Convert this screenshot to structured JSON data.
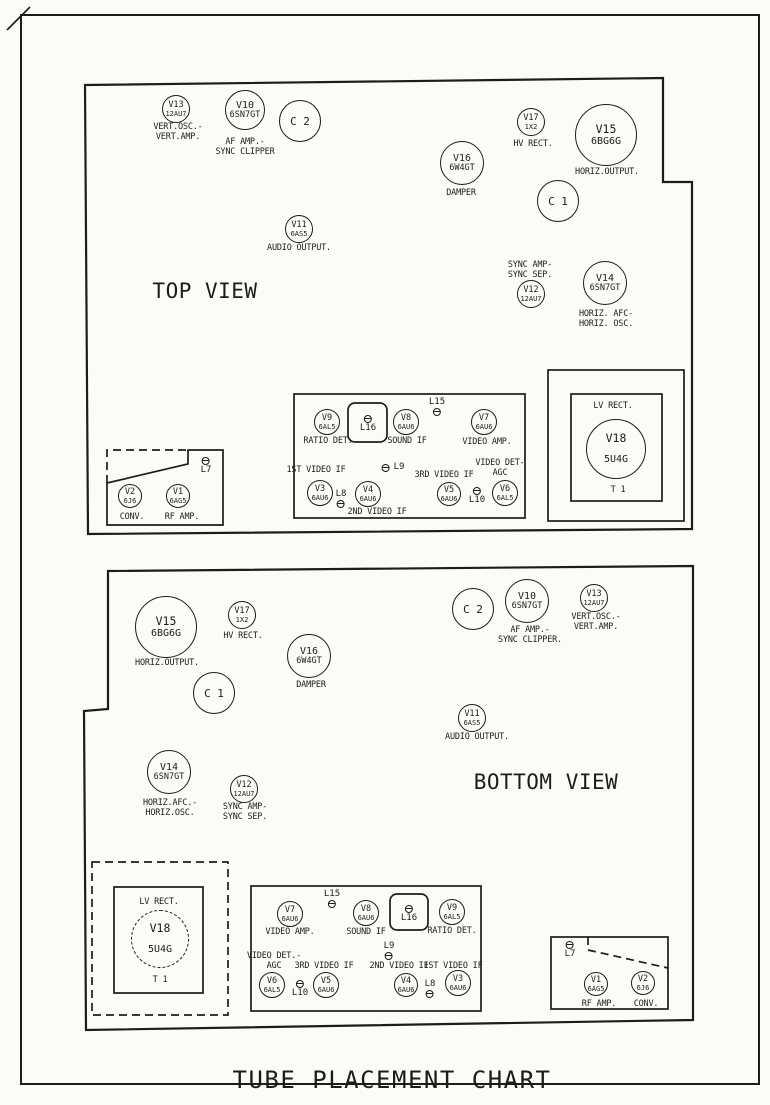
{
  "title": "TUBE PLACEMENT CHART",
  "colors": {
    "ink": "#1c1c1c",
    "paper": "#fbfbf8"
  },
  "marks": [
    {
      "name": "corner-fold-mark",
      "d": "M7,30 L30,7"
    }
  ],
  "panels": [
    {
      "id": "top-view",
      "view_label": {
        "text": "TOP VIEW",
        "x": 205,
        "y": 279
      },
      "outline": [
        [
          85,
          85
        ],
        [
          663,
          78
        ],
        [
          663,
          182
        ],
        [
          692,
          182
        ],
        [
          692,
          529
        ],
        [
          88,
          534
        ]
      ],
      "boxes": [
        {
          "name": "if-strip-box",
          "x": 294,
          "y": 394,
          "w": 231,
          "h": 124
        },
        {
          "name": "coil-l16-box",
          "x": 348,
          "y": 403,
          "w": 39,
          "h": 39,
          "rx": 7
        },
        {
          "name": "lv-rect-outer-box",
          "x": 548,
          "y": 370,
          "w": 136,
          "h": 151
        },
        {
          "name": "lv-rect-inner-box",
          "x": 571,
          "y": 394,
          "w": 91,
          "h": 107
        }
      ],
      "paths": [
        {
          "name": "tuner-box",
          "d": "M107,483 L107,525 L223,525 L223,450 L188,450 L188,464 L107,483"
        },
        {
          "name": "tuner-box-dashed-edge",
          "d": "M107,483 L107,450 L188,450",
          "dash": true
        }
      ],
      "tubes": [
        {
          "id": "V13",
          "type": "12AU7",
          "x": 176,
          "y": 109,
          "r": 14
        },
        {
          "id": "V10",
          "type": "6SN7GT",
          "x": 245,
          "y": 110,
          "r": 20
        },
        {
          "id": "C 2",
          "type": "",
          "x": 300,
          "y": 121,
          "r": 21
        },
        {
          "id": "V17",
          "type": "1X2",
          "x": 531,
          "y": 122,
          "r": 14
        },
        {
          "id": "V15",
          "type": "6BG6G",
          "x": 606,
          "y": 135,
          "r": 31
        },
        {
          "id": "V16",
          "type": "6W4GT",
          "x": 462,
          "y": 163,
          "r": 22
        },
        {
          "id": "C 1",
          "type": "",
          "x": 558,
          "y": 201,
          "r": 21
        },
        {
          "id": "V11",
          "type": "6AS5",
          "x": 299,
          "y": 229,
          "r": 14
        },
        {
          "id": "V12",
          "type": "12AU7",
          "x": 531,
          "y": 294,
          "r": 14
        },
        {
          "id": "V14",
          "type": "6SN7GT",
          "x": 605,
          "y": 283,
          "r": 22
        },
        {
          "id": "V9",
          "type": "6AL5",
          "x": 327,
          "y": 422,
          "r": 13
        },
        {
          "id": "V8",
          "type": "6AU6",
          "x": 406,
          "y": 422,
          "r": 13
        },
        {
          "id": "V7",
          "type": "6AU6",
          "x": 484,
          "y": 422,
          "r": 13
        },
        {
          "id": "V3",
          "type": "6AU6",
          "x": 320,
          "y": 493,
          "r": 13
        },
        {
          "id": "V4",
          "type": "6AU6",
          "x": 368,
          "y": 494,
          "r": 13
        },
        {
          "id": "V5",
          "type": "6AU6",
          "x": 449,
          "y": 494,
          "r": 12
        },
        {
          "id": "V6",
          "type": "6AL5",
          "x": 505,
          "y": 493,
          "r": 13
        },
        {
          "id": "V2",
          "type": "6J6",
          "x": 130,
          "y": 496,
          "r": 12
        },
        {
          "id": "V1",
          "type": "6AG5",
          "x": 178,
          "y": 496,
          "r": 12
        },
        {
          "id": "V18",
          "type": "5U4G",
          "x": 616,
          "y": 449,
          "r": 30,
          "spread": true
        }
      ],
      "coils": [
        {
          "name": "L16",
          "mode": "ta",
          "x": 368,
          "y": 415
        },
        {
          "name": "L15",
          "mode": "tb",
          "x": 437,
          "y": 398
        },
        {
          "name": "L9",
          "mode": "tl",
          "x": 393,
          "y": 463
        },
        {
          "name": "L8",
          "mode": "tb",
          "x": 341,
          "y": 490
        },
        {
          "name": "L10",
          "mode": "ta",
          "x": 477,
          "y": 487
        },
        {
          "name": "L7",
          "mode": "ta",
          "x": 206,
          "y": 457
        }
      ],
      "labels": [
        {
          "lines": [
            "VERT.OSC.-",
            "VERT.AMP."
          ],
          "x": 178,
          "y": 123
        },
        {
          "lines": [
            "AF AMP.-",
            "SYNC CLIPPER"
          ],
          "x": 245,
          "y": 138
        },
        {
          "lines": [
            "HV RECT."
          ],
          "x": 533,
          "y": 140
        },
        {
          "lines": [
            "HORIZ.OUTPUT."
          ],
          "x": 607,
          "y": 168
        },
        {
          "lines": [
            "DAMPER"
          ],
          "x": 461,
          "y": 189
        },
        {
          "lines": [
            "AUDIO OUTPUT."
          ],
          "x": 299,
          "y": 244
        },
        {
          "lines": [
            "SYNC AMP-",
            "SYNC SEP."
          ],
          "x": 530,
          "y": 261
        },
        {
          "lines": [
            "HORIZ. AFC-",
            "HORIZ. OSC."
          ],
          "x": 606,
          "y": 310
        },
        {
          "lines": [
            "RATIO DET."
          ],
          "x": 328,
          "y": 437
        },
        {
          "lines": [
            "SOUND IF"
          ],
          "x": 407,
          "y": 437
        },
        {
          "lines": [
            "VIDEO AMP."
          ],
          "x": 487,
          "y": 438
        },
        {
          "lines": [
            "1ST VIDEO IF"
          ],
          "x": 316,
          "y": 466
        },
        {
          "lines": [
            "3RD VIDEO IF"
          ],
          "x": 444,
          "y": 471
        },
        {
          "lines": [
            "VIDEO DET-",
            "AGC"
          ],
          "x": 500,
          "y": 459
        },
        {
          "lines": [
            "2ND VIDEO IF"
          ],
          "x": 377,
          "y": 508
        },
        {
          "lines": [
            "CONV."
          ],
          "x": 132,
          "y": 513
        },
        {
          "lines": [
            "RF AMP."
          ],
          "x": 182,
          "y": 513
        },
        {
          "lines": [
            "LV RECT."
          ],
          "x": 613,
          "y": 402
        },
        {
          "lines": [
            "T 1"
          ],
          "x": 618,
          "y": 486
        }
      ]
    },
    {
      "id": "bottom-view",
      "view_label": {
        "text": "BOTTOM VIEW",
        "x": 546,
        "y": 770
      },
      "outline": [
        [
          108,
          571
        ],
        [
          693,
          566
        ],
        [
          693,
          1020
        ],
        [
          86,
          1030
        ],
        [
          84,
          711
        ],
        [
          108,
          709
        ]
      ],
      "boxes": [
        {
          "name": "if-strip-box",
          "x": 251,
          "y": 886,
          "w": 230,
          "h": 125
        },
        {
          "name": "coil-l16-box",
          "x": 390,
          "y": 894,
          "w": 38,
          "h": 36,
          "rx": 7
        },
        {
          "name": "lv-rect-outer-box",
          "x": 92,
          "y": 862,
          "w": 136,
          "h": 153,
          "dash": true
        },
        {
          "name": "lv-rect-inner-box",
          "x": 114,
          "y": 887,
          "w": 89,
          "h": 106
        },
        {
          "name": "tuner-box",
          "x": 551,
          "y": 937,
          "w": 117,
          "h": 72
        }
      ],
      "paths": [
        {
          "name": "tuner-divider-dashed",
          "d": "M588,937 L588,950 L668,968",
          "dash": true
        }
      ],
      "tubes": [
        {
          "id": "V15",
          "type": "6BG6G",
          "x": 166,
          "y": 627,
          "r": 31
        },
        {
          "id": "V17",
          "type": "1X2",
          "x": 242,
          "y": 615,
          "r": 14
        },
        {
          "id": "V16",
          "type": "6W4GT",
          "x": 309,
          "y": 656,
          "r": 22
        },
        {
          "id": "C 1",
          "type": "",
          "x": 214,
          "y": 693,
          "r": 21
        },
        {
          "id": "C 2",
          "type": "",
          "x": 473,
          "y": 609,
          "r": 21
        },
        {
          "id": "V10",
          "type": "6SN7GT",
          "x": 527,
          "y": 601,
          "r": 22
        },
        {
          "id": "V13",
          "type": "12AU7",
          "x": 594,
          "y": 598,
          "r": 14
        },
        {
          "id": "V11",
          "type": "6AS5",
          "x": 472,
          "y": 718,
          "r": 14
        },
        {
          "id": "V14",
          "type": "6SN7GT",
          "x": 169,
          "y": 772,
          "r": 22
        },
        {
          "id": "V12",
          "type": "12AU7",
          "x": 244,
          "y": 789,
          "r": 14
        },
        {
          "id": "V18",
          "type": "5U4G",
          "x": 160,
          "y": 939,
          "r": 29,
          "spread": true,
          "dashed": true
        },
        {
          "id": "V7",
          "type": "6AU6",
          "x": 290,
          "y": 914,
          "r": 13
        },
        {
          "id": "V8",
          "type": "6AU6",
          "x": 366,
          "y": 913,
          "r": 13
        },
        {
          "id": "V9",
          "type": "6AL5",
          "x": 452,
          "y": 912,
          "r": 13
        },
        {
          "id": "V6",
          "type": "6AL5",
          "x": 272,
          "y": 985,
          "r": 13
        },
        {
          "id": "V5",
          "type": "6AU6",
          "x": 326,
          "y": 985,
          "r": 13
        },
        {
          "id": "V4",
          "type": "6AU6",
          "x": 406,
          "y": 985,
          "r": 12
        },
        {
          "id": "V3",
          "type": "6AU6",
          "x": 458,
          "y": 983,
          "r": 13
        },
        {
          "id": "V1",
          "type": "6AG5",
          "x": 596,
          "y": 984,
          "r": 12
        },
        {
          "id": "V2",
          "type": "6J6",
          "x": 643,
          "y": 983,
          "r": 12
        }
      ],
      "coils": [
        {
          "name": "L15",
          "mode": "tb",
          "x": 332,
          "y": 890
        },
        {
          "name": "L16",
          "mode": "ta",
          "x": 409,
          "y": 905
        },
        {
          "name": "L9",
          "mode": "tb",
          "x": 389,
          "y": 942
        },
        {
          "name": "L10",
          "mode": "ta",
          "x": 300,
          "y": 980
        },
        {
          "name": "L8",
          "mode": "tb",
          "x": 430,
          "y": 980
        },
        {
          "name": "L7",
          "mode": "ta",
          "x": 570,
          "y": 941
        }
      ],
      "labels": [
        {
          "lines": [
            "HORIZ.OUTPUT."
          ],
          "x": 167,
          "y": 659
        },
        {
          "lines": [
            "HV RECT."
          ],
          "x": 243,
          "y": 632
        },
        {
          "lines": [
            "DAMPER"
          ],
          "x": 311,
          "y": 681
        },
        {
          "lines": [
            "AF AMP.-",
            "SYNC CLIPPER."
          ],
          "x": 530,
          "y": 626
        },
        {
          "lines": [
            "VERT.OSC.-",
            "VERT.AMP."
          ],
          "x": 596,
          "y": 613
        },
        {
          "lines": [
            "AUDIO OUTPUT."
          ],
          "x": 477,
          "y": 733
        },
        {
          "lines": [
            "HORIZ.AFC.-",
            "HORIZ.OSC."
          ],
          "x": 170,
          "y": 799
        },
        {
          "lines": [
            "SYNC AMP-",
            "SYNC SEP."
          ],
          "x": 245,
          "y": 803
        },
        {
          "lines": [
            "LV RECT."
          ],
          "x": 159,
          "y": 898
        },
        {
          "lines": [
            "T 1"
          ],
          "x": 160,
          "y": 976
        },
        {
          "lines": [
            "VIDEO AMP."
          ],
          "x": 290,
          "y": 928
        },
        {
          "lines": [
            "SOUND IF"
          ],
          "x": 366,
          "y": 928
        },
        {
          "lines": [
            "RATIO DET."
          ],
          "x": 452,
          "y": 927
        },
        {
          "lines": [
            "VIDEO DET.-",
            "AGC"
          ],
          "x": 274,
          "y": 952
        },
        {
          "lines": [
            "3RD VIDEO IF"
          ],
          "x": 324,
          "y": 962
        },
        {
          "lines": [
            "2ND VIDEO IF"
          ],
          "x": 399,
          "y": 962
        },
        {
          "lines": [
            "1ST VIDEO IF"
          ],
          "x": 453,
          "y": 962
        },
        {
          "lines": [
            "RF AMP."
          ],
          "x": 599,
          "y": 1000
        },
        {
          "lines": [
            "CONV."
          ],
          "x": 646,
          "y": 1000
        }
      ]
    }
  ]
}
